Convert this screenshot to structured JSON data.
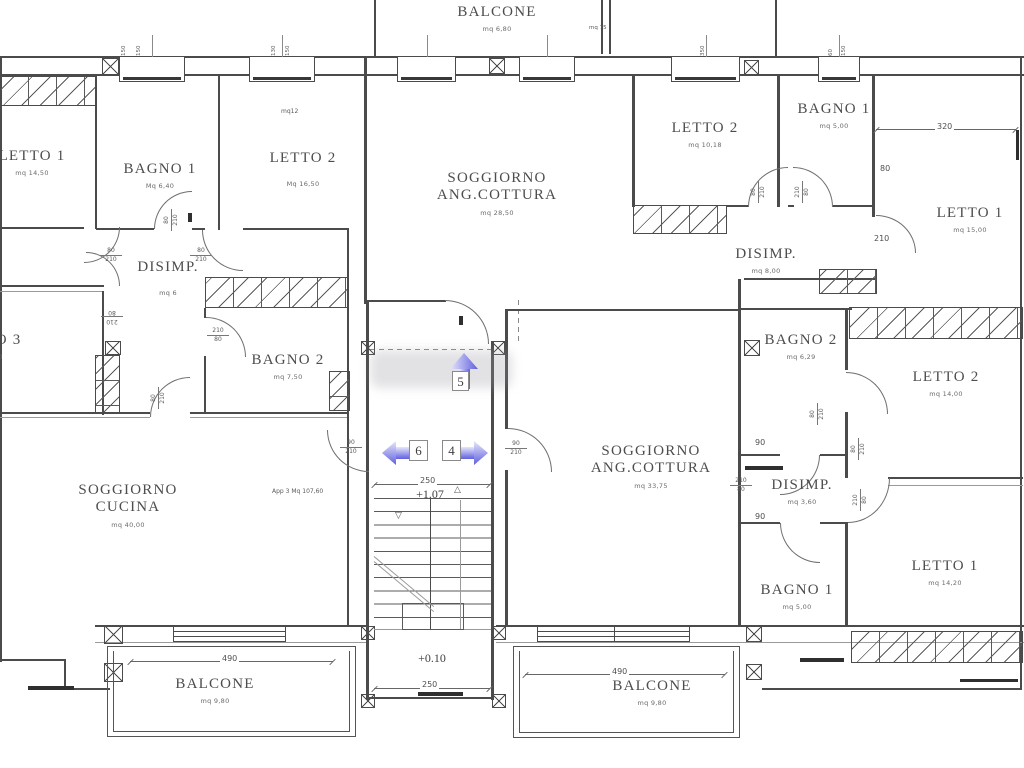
{
  "rooms": {
    "balcone_top": {
      "name": "BALCONE",
      "area": "mq 6,80"
    },
    "letto1_left": {
      "name": "LETTO 1",
      "area": "mq 14,50"
    },
    "bagno1_left": {
      "name": "BAGNO 1",
      "area": "Mq 6,40"
    },
    "letto2_left": {
      "name": "LETTO 2",
      "area": "Mq 16,50",
      "note": "mq12"
    },
    "disimp_left": {
      "name": "DISIMP.",
      "area": "mq 6"
    },
    "letto3_left": {
      "name": "LETTO 3",
      "area": "mq 9,50"
    },
    "bagno2_left": {
      "name": "BAGNO 2",
      "area": "mq 7,50"
    },
    "soggiorno_cucina": {
      "name": "SOGGIORNO",
      "name2": "CUCINA",
      "area": "mq 40,00"
    },
    "soggiorno_center": {
      "name": "SOGGIORNO",
      "name2": "ANG.COTTURA",
      "area": "mq 28,50"
    },
    "soggiorno_right": {
      "name": "SOGGIORNO",
      "name2": "ANG.COTTURA",
      "area": "mq 33,75"
    },
    "letto2_topright": {
      "name": "LETTO 2",
      "area": "mq 10,18"
    },
    "bagno1_topright": {
      "name": "BAGNO 1",
      "area": "mq 5,00"
    },
    "disimp_topright": {
      "name": "DISIMP.",
      "area": "mq 8,00"
    },
    "letto1_topright": {
      "name": "LETTO 1",
      "area": "mq 15,00"
    },
    "bagno2_right": {
      "name": "BAGNO 2",
      "area": "mq 6,29"
    },
    "letto2_right": {
      "name": "LETTO 2",
      "area": "mq 14,00"
    },
    "disimp_right": {
      "name": "DISIMP.",
      "area": "mq 3,60"
    },
    "bagno1_right": {
      "name": "BAGNO 1",
      "area": "mq 5,00"
    },
    "letto1_right": {
      "name": "LETTO 1",
      "area": "mq 14,20"
    },
    "balcone_bottom_left": {
      "name": "BALCONE",
      "area": "mq 9,80"
    },
    "balcone_bottom_right": {
      "name": "BALCONE",
      "area": "mq 9,80"
    }
  },
  "notes": {
    "apartment": "App 3  Mq 107,60",
    "mq75": "mq 75"
  },
  "levels": {
    "upper": "+1.07",
    "entry": "+0.10"
  },
  "stair_arrows": {
    "up": "5",
    "left": "6",
    "right": "4"
  },
  "dims": {
    "stair_top": "250",
    "stair_bottom": "250",
    "balcony_left": "490",
    "balcony_right": "490",
    "letto1_width": "320",
    "wall_80": "80",
    "door_210": "210",
    "door_90_upper": "90",
    "door_90_lower": "90"
  },
  "door_dims": [
    {
      "w": "80",
      "h": "210"
    },
    {
      "w": "80",
      "h": "210"
    },
    {
      "w": "210",
      "h": "80"
    },
    {
      "w": "210",
      "h": "80"
    },
    {
      "w": "80",
      "h": "210"
    },
    {
      "w": "80",
      "h": "210"
    },
    {
      "w": "90",
      "h": "210"
    },
    {
      "w": "90",
      "h": "210"
    },
    {
      "w": "80",
      "h": "210"
    },
    {
      "w": "210",
      "h": "80"
    },
    {
      "w": "80",
      "h": "210"
    },
    {
      "w": "80",
      "h": "210"
    },
    {
      "w": "210",
      "h": "80"
    },
    {
      "w": "210",
      "h": "80"
    }
  ],
  "window_dims": [
    {
      "a": "150",
      "b": "150"
    },
    {
      "a": "130",
      "b": "150"
    },
    {
      "a": "350"
    },
    {
      "a": "60",
      "b": "150"
    }
  ],
  "markers": {
    "up_triangle": "△",
    "down_triangle": "▽"
  }
}
